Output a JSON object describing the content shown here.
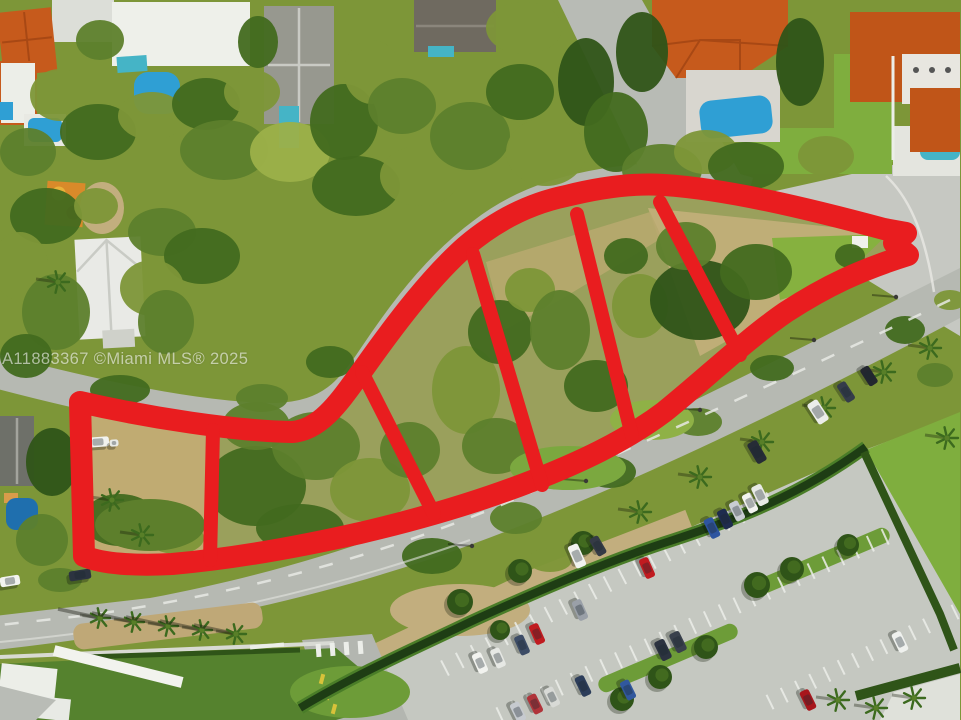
{
  "watermark": {
    "text": "A11883367 ©Miami MLS® 2025"
  },
  "overlay": {
    "color": "#e91d1f",
    "parcel_count": 6,
    "outer_path": "M 80 402 C 150 418 235 431 292 432 C 322 430 342 398 364 368 C 398 320 432 276 466 246 C 498 219 532 203 566 196 C 602 187 636 183 664 185 C 726 189 806 208 884 229 L 906 233 L 894 243 L 908 255 C 860 270 826 286 786 312 C 748 338 706 378 664 412 C 624 442 578 463 532 481 C 478 502 420 519 360 533 C 298 547 230 559 172 564 C 136 566 102 564 84 556 Z",
    "outer_width": 22,
    "divider_width": 14,
    "dividers": [
      "M 213 430 L 210 560",
      "M 362 372 L 434 514",
      "M 473 254 L 542 485",
      "M 577 214 L 632 436",
      "M 660 202 L 740 355"
    ]
  },
  "colors": {
    "road": "#b6b9b2",
    "road_light": "#c6c8c2",
    "parking": "#c5c8c1",
    "dirt": "#c2ae7e",
    "parcel_tan": "#c0ab72",
    "parcel_olive": "#9aa05c",
    "lawn": "#7fae3e",
    "lawn_dark": "#55822e",
    "hedge": "#1e3d14",
    "hedge_light": "#4a7d28",
    "pool_blue": "#2f9fd4",
    "pool_teal": "#45b4c6",
    "pool_deep": "#1f6fae",
    "roof_orange": "#c65a1c",
    "roof_orange_dark": "#a84814",
    "roof_gray": "#97988f",
    "roof_dark_gray": "#6e7069",
    "roof_white": "#eef0ea"
  },
  "scene": {
    "canopy_palette": [
      "#7d9638",
      "#5d7f2c",
      "#426a1f",
      "#9cb049",
      "#b2c05e",
      "#2f5418"
    ],
    "canopy": [
      [
        100,
        40,
        24,
        20,
        1
      ],
      [
        60,
        95,
        30,
        26,
        0
      ],
      [
        98,
        132,
        38,
        28,
        2
      ],
      [
        28,
        152,
        28,
        24,
        1
      ],
      [
        152,
        116,
        34,
        24,
        0
      ],
      [
        206,
        104,
        34,
        26,
        2
      ],
      [
        252,
        92,
        28,
        22,
        0
      ],
      [
        224,
        150,
        44,
        30,
        1
      ],
      [
        290,
        152,
        40,
        30,
        3
      ],
      [
        344,
        122,
        34,
        38,
        2
      ],
      [
        372,
        72,
        28,
        32,
        0
      ],
      [
        402,
        106,
        34,
        28,
        1
      ],
      [
        356,
        186,
        44,
        30,
        2
      ],
      [
        420,
        176,
        40,
        30,
        0
      ],
      [
        470,
        136,
        40,
        34,
        1
      ],
      [
        520,
        92,
        34,
        28,
        2
      ],
      [
        546,
        152,
        40,
        34,
        0
      ],
      [
        586,
        82,
        28,
        44,
        5
      ],
      [
        616,
        132,
        32,
        40,
        2
      ],
      [
        642,
        52,
        26,
        40,
        5
      ],
      [
        662,
        170,
        40,
        26,
        1
      ],
      [
        706,
        152,
        32,
        22,
        0
      ],
      [
        746,
        166,
        38,
        24,
        2
      ],
      [
        800,
        62,
        24,
        44,
        5
      ],
      [
        826,
        156,
        28,
        20,
        0
      ],
      [
        258,
        42,
        20,
        26,
        2
      ],
      [
        524,
        28,
        38,
        26,
        0
      ],
      [
        46,
        216,
        36,
        28,
        2
      ],
      [
        20,
        266,
        28,
        34,
        0
      ],
      [
        56,
        312,
        34,
        38,
        1
      ],
      [
        26,
        356,
        26,
        22,
        2
      ],
      [
        96,
        206,
        22,
        18,
        0
      ],
      [
        162,
        232,
        34,
        24,
        1
      ],
      [
        202,
        256,
        38,
        28,
        2
      ],
      [
        152,
        288,
        32,
        28,
        0
      ],
      [
        166,
        322,
        28,
        32,
        1
      ],
      [
        52,
        462,
        26,
        34,
        5
      ],
      [
        42,
        540,
        26,
        26,
        1
      ],
      [
        120,
        390,
        30,
        15,
        2
      ],
      [
        262,
        398,
        26,
        14,
        1
      ],
      [
        330,
        362,
        24,
        16,
        2
      ],
      [
        120,
        520,
        38,
        26,
        2
      ],
      [
        176,
        538,
        28,
        16,
        0
      ],
      [
        256,
        486,
        50,
        40,
        2
      ],
      [
        316,
        446,
        44,
        34,
        1
      ],
      [
        370,
        490,
        40,
        32,
        0
      ],
      [
        300,
        528,
        44,
        24,
        2
      ],
      [
        256,
        426,
        34,
        24,
        1
      ],
      [
        410,
        450,
        30,
        28,
        1
      ],
      [
        466,
        390,
        34,
        44,
        0
      ],
      [
        500,
        332,
        32,
        32,
        2
      ],
      [
        496,
        446,
        34,
        28,
        1
      ],
      [
        530,
        290,
        25,
        22,
        0
      ],
      [
        560,
        330,
        30,
        40,
        1
      ],
      [
        596,
        386,
        32,
        26,
        2
      ],
      [
        640,
        306,
        28,
        32,
        0
      ],
      [
        626,
        256,
        22,
        18,
        2
      ],
      [
        700,
        300,
        50,
        40,
        5
      ],
      [
        756,
        272,
        36,
        28,
        2
      ],
      [
        686,
        246,
        30,
        24,
        1
      ],
      [
        850,
        256,
        15,
        12,
        2
      ],
      [
        432,
        556,
        30,
        18,
        2
      ],
      [
        516,
        518,
        26,
        16,
        1
      ],
      [
        610,
        472,
        26,
        16,
        2
      ],
      [
        698,
        422,
        24,
        14,
        1
      ],
      [
        772,
        368,
        22,
        13,
        2
      ],
      [
        550,
        560,
        22,
        12,
        0
      ],
      [
        60,
        580,
        22,
        12,
        1
      ],
      [
        905,
        330,
        20,
        14,
        2
      ],
      [
        935,
        375,
        18,
        12,
        1
      ],
      [
        950,
        300,
        16,
        10,
        0
      ]
    ],
    "grass_patches": [
      [
        568,
        468,
        58,
        22,
        "#7ba83f"
      ],
      [
        652,
        420,
        42,
        20,
        "#8fb146"
      ],
      [
        150,
        525,
        55,
        26,
        "#5d7f2c"
      ],
      [
        350,
        692,
        60,
        26,
        "#6d9c38"
      ],
      [
        460,
        610,
        70,
        26,
        "#c2ae7e"
      ]
    ],
    "round_trees": [
      [
        460,
        602,
        13
      ],
      [
        520,
        571,
        12
      ],
      [
        583,
        543,
        12
      ],
      [
        757,
        585,
        13
      ],
      [
        792,
        569,
        12
      ],
      [
        706,
        647,
        12
      ],
      [
        660,
        677,
        12
      ],
      [
        622,
        699,
        12
      ],
      [
        848,
        545,
        11
      ],
      [
        500,
        630,
        10
      ]
    ],
    "palms": [
      [
        112,
        500
      ],
      [
        142,
        535
      ],
      [
        640,
        512
      ],
      [
        700,
        477
      ],
      [
        762,
        442
      ],
      [
        824,
        408
      ],
      [
        884,
        372
      ],
      [
        930,
        348
      ],
      [
        838,
        700
      ],
      [
        876,
        708
      ],
      [
        914,
        698
      ],
      [
        947,
        438
      ],
      [
        58,
        282
      ]
    ],
    "median_palms": [
      [
        100,
        618
      ],
      [
        134,
        622
      ],
      [
        168,
        626
      ],
      [
        202,
        630
      ],
      [
        236,
        634
      ]
    ],
    "lights": [
      [
        472,
        546
      ],
      [
        586,
        481
      ],
      [
        700,
        410
      ],
      [
        814,
        340
      ],
      [
        896,
        297
      ]
    ],
    "stall_rows": [
      {
        "x1": 445,
        "y1": 668,
        "x2": 770,
        "y2": 500,
        "n": 22,
        "len": 17
      },
      {
        "x1": 500,
        "y1": 715,
        "x2": 900,
        "y2": 530,
        "n": 27,
        "len": 17
      },
      {
        "x1": 770,
        "y1": 702,
        "x2": 955,
        "y2": 612,
        "n": 13,
        "len": 16
      }
    ],
    "cars": [
      [
        98,
        442,
        -4,
        "#f2f3ef",
        22,
        10
      ],
      [
        114,
        443,
        -4,
        "#e8eae6",
        9,
        7
      ],
      [
        10,
        581,
        -9,
        "#f2f3ef",
        20,
        10
      ],
      [
        80,
        575,
        -9,
        "#2c3340",
        22,
        10
      ],
      [
        577,
        556,
        66,
        "#f2f3ef",
        24,
        11
      ],
      [
        598,
        546,
        60,
        "#353b46",
        20,
        10
      ],
      [
        647,
        568,
        66,
        "#c01b20",
        21,
        10
      ],
      [
        580,
        610,
        66,
        "#9aa0a8",
        21,
        10
      ],
      [
        537,
        634,
        66,
        "#c01b20",
        21,
        10
      ],
      [
        522,
        645,
        66,
        "#3c4c66",
        20,
        10
      ],
      [
        480,
        663,
        66,
        "#f2f3ef",
        21,
        10
      ],
      [
        498,
        658,
        66,
        "#e6e8e4",
        20,
        10
      ],
      [
        663,
        650,
        64,
        "#2c3340",
        21,
        11
      ],
      [
        678,
        642,
        64,
        "#39404c",
        21,
        11
      ],
      [
        583,
        686,
        64,
        "#2c3d5a",
        21,
        10
      ],
      [
        535,
        704,
        64,
        "#b0343a",
        20,
        10
      ],
      [
        552,
        697,
        64,
        "#d8dad6",
        20,
        10
      ],
      [
        518,
        712,
        64,
        "#c6cacf",
        20,
        10
      ],
      [
        712,
        528,
        64,
        "#2e55a0",
        21,
        10
      ],
      [
        725,
        519,
        64,
        "#1f2c4e",
        20,
        10
      ],
      [
        737,
        511,
        64,
        "#c9cdd2",
        20,
        10
      ],
      [
        750,
        503,
        64,
        "#f2f3ef",
        20,
        10
      ],
      [
        760,
        495,
        64,
        "#e8eae6",
        21,
        11
      ],
      [
        757,
        452,
        60,
        "#262c36",
        23,
        11
      ],
      [
        818,
        412,
        57,
        "#ebedea",
        24,
        12
      ],
      [
        846,
        392,
        57,
        "#343c4a",
        21,
        10
      ],
      [
        869,
        376,
        57,
        "#23272f",
        20,
        10
      ],
      [
        808,
        700,
        64,
        "#a8161c",
        21,
        10
      ],
      [
        900,
        642,
        64,
        "#eff1ee",
        21,
        10
      ],
      [
        628,
        690,
        64,
        "#31589e",
        20,
        10
      ]
    ]
  }
}
